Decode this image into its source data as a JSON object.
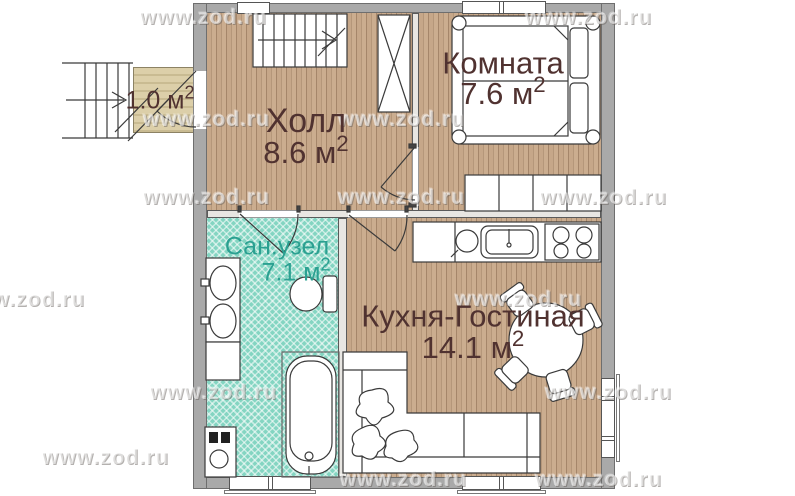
{
  "watermark": {
    "text": "www.zod.ru"
  },
  "rooms": {
    "hall": {
      "name": "Холл",
      "area_value": "8.6 м",
      "area_sup": "2"
    },
    "bedroom": {
      "name": "Комната",
      "area_value": "7.6 м",
      "area_sup": "2"
    },
    "bathroom": {
      "name": "Сан.узел",
      "area_value": "7.1 м",
      "area_sup": "2"
    },
    "kitchen_living": {
      "name": "Кухня-Гостиная",
      "area_value": "14.1 м",
      "area_sup": "2"
    },
    "porch": {
      "area_value": "1.0 м",
      "area_sup": "2"
    }
  },
  "colors": {
    "wood_floor": "#c6a789",
    "wood_stripe": "#a5866a",
    "bath_tile": "#84d5c2",
    "porch_floor": "#dccfa9",
    "exterior_wall": "#a9a9a9",
    "label_text": "#503230",
    "bathroom_label_text": "#2ba091",
    "furniture_outline": "#3a3a3a"
  }
}
